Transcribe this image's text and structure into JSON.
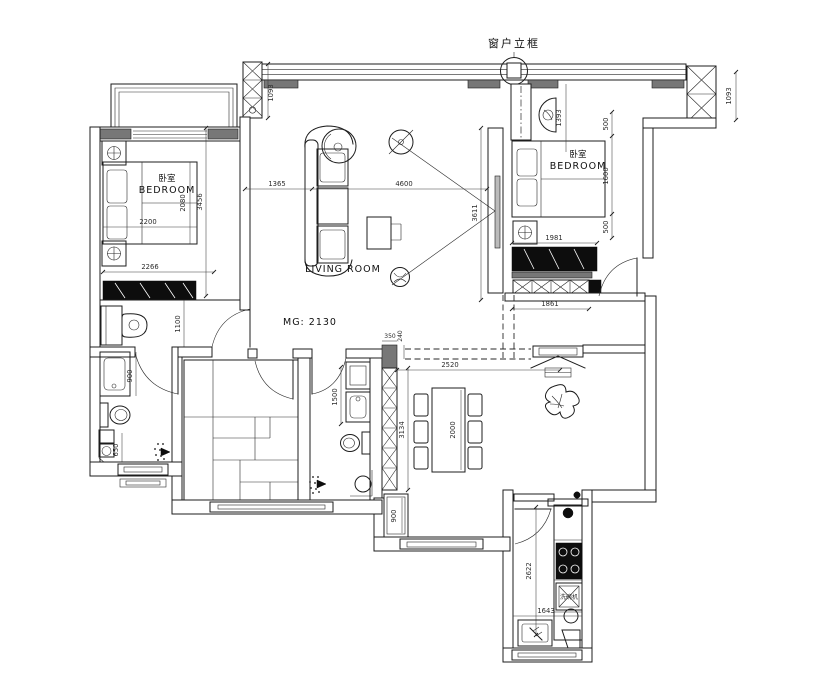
{
  "annotations": {
    "window_frame_callout": "窗户立框",
    "mg_note": "MG: 2130"
  },
  "rooms": {
    "bedroom_left": {
      "name_zh": "卧室",
      "name_en": "BEDROOM"
    },
    "bedroom_right": {
      "name_zh": "卧室",
      "name_en": "BEDROOM"
    },
    "living_room": {
      "name_en": "LIVING ROOM"
    },
    "kitchen": {
      "dishwasher_label": "洗碗机"
    }
  },
  "dimensions_mm": {
    "top_wall_left_column": "1093",
    "top_wall_right_column": "1093",
    "living_sofa_offset": "1365",
    "living_width": "4600",
    "living_depth": "3611",
    "bedroom_left_bed_width": "2200",
    "bedroom_left_bed_depth": "2080",
    "bedroom_left_depth": "3456",
    "bedroom_left_width": "2266",
    "dressing_nook_depth": "1100",
    "bath_left_vanity": "900",
    "bath_left_shower": "650",
    "bedroom_right_armchair": "1393",
    "bedroom_right_gap_top": "500",
    "bedroom_right_bed": "1600",
    "bedroom_right_gap_bottom": "500",
    "bedroom_right_wardrobe": "1981",
    "bedroom_right_cabinet": "1861",
    "hall_column_width": "350",
    "hall_beam_offset": "240",
    "dining_width": "2520",
    "dining_depth": "3134",
    "dining_table_length": "2000",
    "bath_mid_vanity": "1500",
    "hall_cabinet": "900",
    "kitchen_depth": "2622",
    "kitchen_width": "1643"
  }
}
